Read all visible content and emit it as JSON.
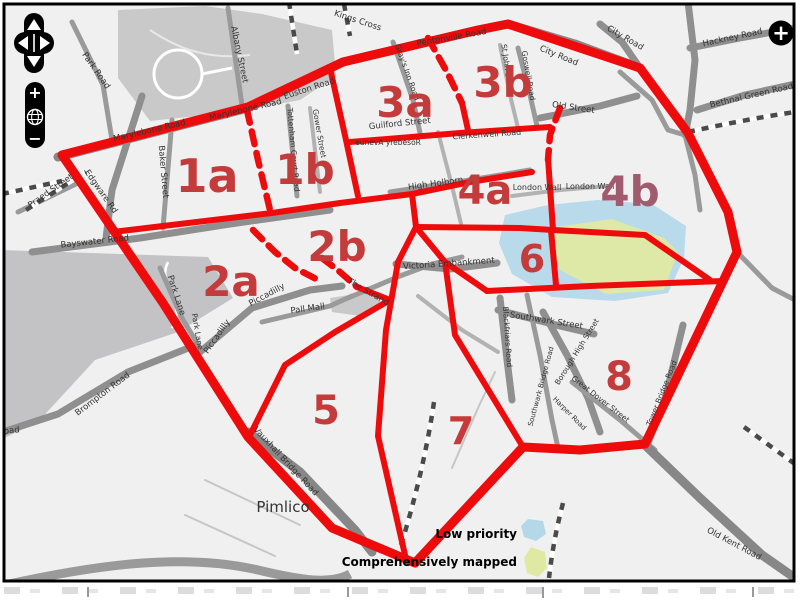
{
  "map_title": "London mapping priority zones",
  "colors": {
    "boundary_red": "#ee0b0b",
    "zone_label_red": "#c43b3b",
    "zone_label_muted": "#a05b6e",
    "low_priority_blue": "#b5d8e9",
    "mapped_green": "#dfe9a3",
    "road_gray": "#8f8f8f",
    "park_gray": "#c9c9ca",
    "map_background": "#f0f0f1"
  },
  "controls": {
    "pan": {
      "up": "pan-up",
      "down": "pan-down",
      "left": "pan-left",
      "right": "pan-right"
    },
    "zoom_in_label": "+",
    "zoom_out_label": "−",
    "globe_icon": "globe",
    "add_button_label": "+"
  },
  "legend": {
    "items": [
      {
        "label": "Low priority",
        "color": "#b5d8e9"
      },
      {
        "label": "Comprehensively mapped",
        "color": "#dfe9a3"
      }
    ]
  },
  "zones": [
    {
      "label": "1a",
      "x": 207,
      "y": 192,
      "s": 46
    },
    {
      "label": "1b",
      "x": 305,
      "y": 184,
      "s": 42
    },
    {
      "label": "2a",
      "x": 231,
      "y": 296,
      "s": 42
    },
    {
      "label": "2b",
      "x": 337,
      "y": 261,
      "s": 42
    },
    {
      "label": "3a",
      "x": 405,
      "y": 117,
      "s": 42
    },
    {
      "label": "3b",
      "x": 503,
      "y": 97,
      "s": 42
    },
    {
      "label": "4a",
      "x": 485,
      "y": 204,
      "s": 40
    },
    {
      "label": "4b",
      "x": 630,
      "y": 206,
      "s": 42,
      "c": "#a05b6e"
    },
    {
      "label": "5",
      "x": 326,
      "y": 424,
      "s": 40
    },
    {
      "label": "6",
      "x": 532,
      "y": 272,
      "s": 38
    },
    {
      "label": "7",
      "x": 461,
      "y": 444,
      "s": 38
    },
    {
      "label": "8",
      "x": 619,
      "y": 390,
      "s": 40
    }
  ],
  "street_labels": [
    {
      "n": "Park Road",
      "x": 94,
      "y": 72,
      "r": 55
    },
    {
      "n": "Albany Street",
      "x": 237,
      "y": 55,
      "r": 78
    },
    {
      "n": "Kings Cross",
      "x": 357,
      "y": 23,
      "r": 18
    },
    {
      "n": "Pentonville Road",
      "x": 452,
      "y": 40,
      "r": -10,
      "c": "#222"
    },
    {
      "n": "Euston Road",
      "x": 310,
      "y": 91,
      "r": -18
    },
    {
      "n": "Marylebone Road",
      "x": 150,
      "y": 133,
      "r": -13
    },
    {
      "n": "Marylebone Road",
      "x": 246,
      "y": 112,
      "r": -13
    },
    {
      "n": "Baker Street",
      "x": 161,
      "y": 172,
      "r": 85
    },
    {
      "n": "Edgware Rd",
      "x": 99,
      "y": 193,
      "r": 55
    },
    {
      "n": "Praed Street",
      "x": 52,
      "y": 193,
      "r": -35
    },
    {
      "n": "Bayswater Road",
      "x": 95,
      "y": 244,
      "r": -6
    },
    {
      "n": "Park Lane",
      "x": 174,
      "y": 296,
      "r": 72
    },
    {
      "n": "Park Lane",
      "x": 195,
      "y": 332,
      "r": 80,
      "s": 7.5
    },
    {
      "n": "Piccadilly",
      "x": 268,
      "y": 297,
      "r": -28
    },
    {
      "n": "Piccadilly",
      "x": 219,
      "y": 338,
      "r": -55
    },
    {
      "n": "Pall Mall",
      "x": 308,
      "y": 311,
      "r": -8
    },
    {
      "n": "The Strand",
      "x": 367,
      "y": 294,
      "r": 30
    },
    {
      "n": "Tottenham Court Road",
      "x": 291,
      "y": 150,
      "r": 85,
      "s": 7.5
    },
    {
      "n": "Gower Street",
      "x": 317,
      "y": 134,
      "r": 80,
      "s": 7.5
    },
    {
      "n": "Gray's Inn Road",
      "x": 405,
      "y": 73,
      "r": 70,
      "s": 7.5
    },
    {
      "n": "Guilford Street",
      "x": 400,
      "y": 126,
      "r": -6
    },
    {
      "n": "eunevA yrebesoR",
      "x": 388,
      "y": 145,
      "r": 0,
      "s": 7.5
    },
    {
      "n": "High Holborn",
      "x": 436,
      "y": 186,
      "r": -8
    },
    {
      "n": "St John Street",
      "x": 505,
      "y": 70,
      "r": 82,
      "s": 7.5,
      "c": "#555"
    },
    {
      "n": "Goswell Road",
      "x": 526,
      "y": 76,
      "r": 80,
      "s": 7.5
    },
    {
      "n": "City Road",
      "x": 558,
      "y": 58,
      "r": 22
    },
    {
      "n": "City Road",
      "x": 624,
      "y": 40,
      "r": 30
    },
    {
      "n": "Old Street",
      "x": 573,
      "y": 110,
      "r": 8
    },
    {
      "n": "Clerkenwell Road",
      "x": 487,
      "y": 137,
      "r": -4,
      "s": 8,
      "c": "#222"
    },
    {
      "n": "Hackney Road",
      "x": 733,
      "y": 40,
      "r": -12
    },
    {
      "n": "Bethnal Green Road",
      "x": 752,
      "y": 98,
      "r": -13
    },
    {
      "n": "London Wall",
      "x": 537,
      "y": 190,
      "r": 0,
      "s": 8,
      "c": "#44505a"
    },
    {
      "n": "London Wall",
      "x": 590,
      "y": 189,
      "r": 0,
      "s": 8,
      "c": "#44505a"
    },
    {
      "n": "Victoria Embankment",
      "x": 449,
      "y": 266,
      "r": -4
    },
    {
      "n": "Southwark Street",
      "x": 546,
      "y": 323,
      "r": 9
    },
    {
      "n": "Blackfriars Road",
      "x": 505,
      "y": 337,
      "r": 86,
      "s": 7.5
    },
    {
      "n": "Borough High Street",
      "x": 579,
      "y": 353,
      "r": -58,
      "s": 7.5
    },
    {
      "n": "Southwark Bridge Road",
      "x": 543,
      "y": 387,
      "r": -75,
      "s": 7
    },
    {
      "n": "Great Dover Street",
      "x": 599,
      "y": 401,
      "r": 38,
      "s": 7.5
    },
    {
      "n": "Harper Road",
      "x": 568,
      "y": 415,
      "r": 45,
      "s": 7
    },
    {
      "n": "Tower Bridge Road",
      "x": 664,
      "y": 394,
      "r": -68,
      "s": 7.5
    },
    {
      "n": "Old Kent Road",
      "x": 733,
      "y": 546,
      "r": 28
    },
    {
      "n": "Vauxhall Bridge Road",
      "x": 284,
      "y": 463,
      "r": 47
    },
    {
      "n": "Brompton Road",
      "x": 104,
      "y": 396,
      "r": -37
    },
    {
      "n": "oad",
      "x": 12,
      "y": 433,
      "r": -6
    },
    {
      "n": "Pimlico",
      "x": 283,
      "y": 512,
      "r": 0,
      "s": 15,
      "c": "#111"
    }
  ]
}
